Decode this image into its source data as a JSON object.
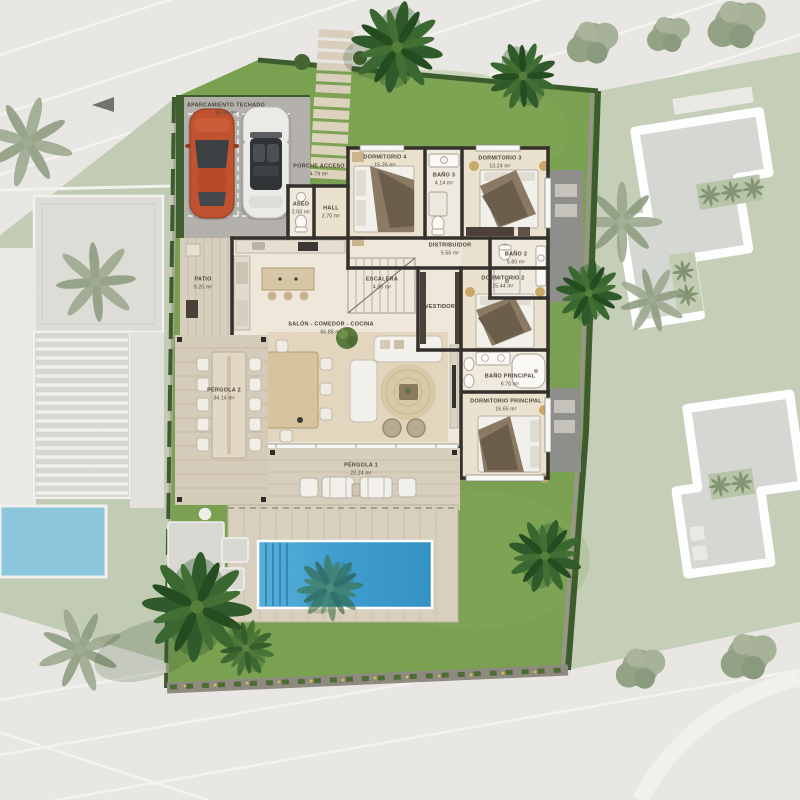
{
  "plan": {
    "unit": "m²",
    "rooms": [
      {
        "key": "aparcamiento",
        "label": "APARCAMIENTO TECHADO",
        "area": "36.94 m²"
      },
      {
        "key": "porche",
        "label": "PORCHE ACCESO",
        "area": "4.79 m²"
      },
      {
        "key": "aseo",
        "label": "ASEO",
        "area": "2.00 m²"
      },
      {
        "key": "hall",
        "label": "HALL",
        "area": "2.70 m²"
      },
      {
        "key": "dormitorio4",
        "label": "DORMITORIO 4",
        "area": "15.26 m²"
      },
      {
        "key": "bano3",
        "label": "BAÑO 3",
        "area": "4.14 m²"
      },
      {
        "key": "dormitorio3",
        "label": "DORMITORIO 3",
        "area": "13.24 m²"
      },
      {
        "key": "distribuidor",
        "label": "DISTRIBUIDOR",
        "area": "5.56 m²"
      },
      {
        "key": "bano2",
        "label": "BAÑO 2",
        "area": "5.80 m²"
      },
      {
        "key": "dormitorio2",
        "label": "DORMITORIO 2",
        "area": "15.44 m²"
      },
      {
        "key": "vestidor",
        "label": "VESTIDOR",
        "area": ""
      },
      {
        "key": "escalera",
        "label": "ESCALERA",
        "area": "4.96 m²"
      },
      {
        "key": "patio",
        "label": "PATIO",
        "area": "9.20 m²"
      },
      {
        "key": "salon",
        "label": "SALÓN - COMEDOR - COCINA",
        "area": "66.88 m²"
      },
      {
        "key": "banoprincipal",
        "label": "BAÑO PRINCIPAL",
        "area": "6.70 m²"
      },
      {
        "key": "dormprincipal",
        "label": "DORMITORIO PRINCIPAL",
        "area": "16.65 m²"
      },
      {
        "key": "pergola2",
        "label": "PÉRGOLA 2",
        "area": "34.14 m²"
      },
      {
        "key": "pergola1",
        "label": "PÉRGOLA 1",
        "area": "22.24 m²"
      }
    ],
    "colors": {
      "lawn": "#7aa150",
      "mutedLawn": "#c6cfb8",
      "hedge": "#3c5c2d",
      "wall": "#332f2a",
      "pool": "#3f9ed0",
      "neighborPool": "#8cc7de",
      "deck": "#d8cfbe",
      "carport": "#b4b1ac",
      "floor": "#ece2d0",
      "road": "#e9e7e3",
      "carOrange": "#c2512f",
      "carWhite": "#ebebe8"
    }
  }
}
